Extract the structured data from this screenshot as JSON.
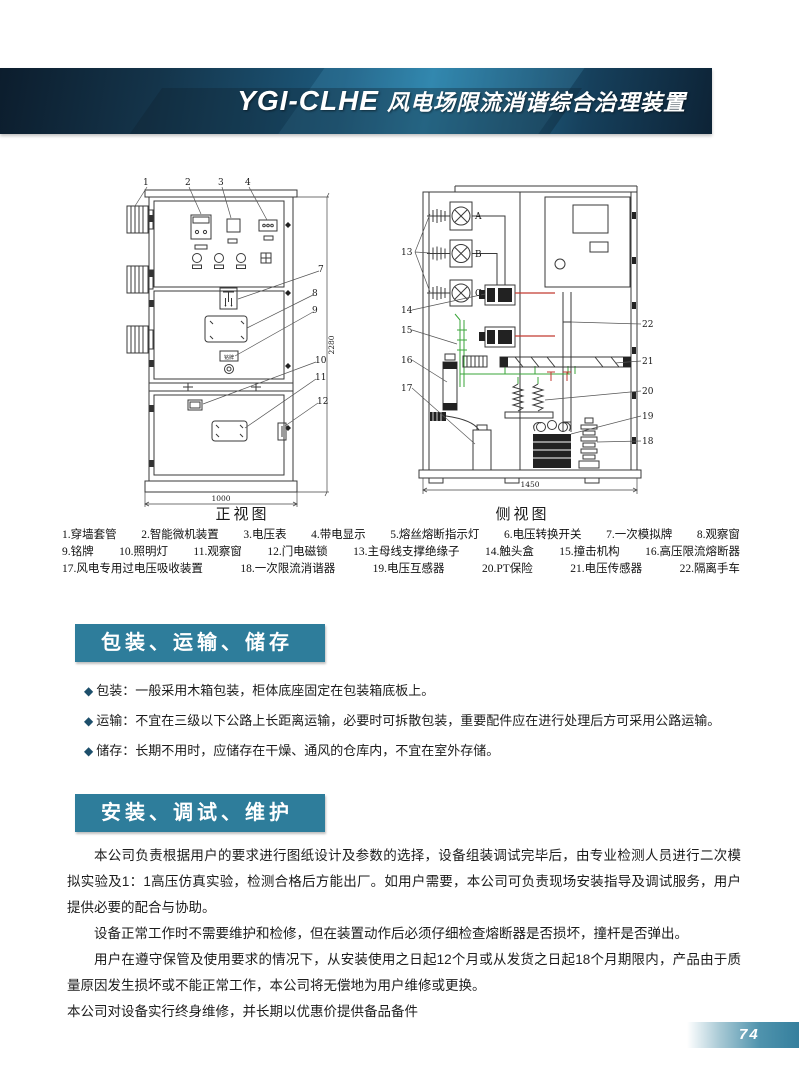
{
  "header": {
    "title_latin": "YGI-CLHE",
    "title_cn": "风电场限流消谐综合治理装置"
  },
  "diagrams": {
    "front": {
      "caption": "正视图",
      "width_dim": "1000",
      "height_dim": "2280",
      "nameplate_text": "铭牌",
      "top_callouts": [
        "1",
        "2",
        "3",
        "4"
      ],
      "right_callouts": [
        "7",
        "8",
        "9",
        "10",
        "11",
        "12"
      ]
    },
    "side": {
      "caption": "侧视图",
      "width_dim": "1450",
      "phases": [
        "A",
        "B",
        "C"
      ],
      "left_callouts": [
        "13",
        "14",
        "15",
        "16",
        "17"
      ],
      "right_callouts": [
        "22",
        "21",
        "20",
        "19",
        "18"
      ]
    }
  },
  "parts_rows": [
    [
      "1.穿墙套管",
      "2.智能微机装置",
      "3.电压表",
      "4.带电显示",
      "5.熔丝熔断指示灯",
      "6.电压转换开关",
      "7.一次模拟牌",
      "8.观察窗"
    ],
    [
      "9.铭牌",
      "10.照明灯",
      "11.观察窗",
      "12.门电磁锁",
      "13.主母线支撑绝缘子",
      "14.触头盒",
      "15.撞击机构",
      "16.高压限流熔断器"
    ],
    [
      "17.风电专用过电压吸收装置",
      "18.一次限流消谐器",
      "19.电压互感器",
      "20.PT保险",
      "21.电压传感器",
      "22.隔离手车"
    ]
  ],
  "sections": {
    "packing": {
      "title": "包装、运输、储存",
      "bullets": [
        {
          "marker": "◆",
          "label": "包装：",
          "text": "一般采用木箱包装，柜体底座固定在包装箱底板上。"
        },
        {
          "marker": "◆",
          "label": "运输：",
          "text": "不宜在三级以下公路上长距离运输，必要时可拆散包装，重要配件应在进行处理后方可采用公路运输。"
        },
        {
          "marker": "◆",
          "label": "储存：",
          "text": "长期不用时，应储存在干燥、通风的仓库内，不宜在室外存储。"
        }
      ]
    },
    "install": {
      "title": "安装、调试、维护",
      "paragraphs": [
        "本公司负责根据用户的要求进行图纸设计及参数的选择，设备组装调试完毕后，由专业检测人员进行二次模拟实验及1：1高压仿真实验，检测合格后方能出厂。如用户需要，本公司可负责现场安装指导及调试服务，用户提供必要的配合与协助。",
        "设备正常工作时不需要维护和检修，但在装置动作后必须仔细检查熔断器是否损坏，撞杆是否弹出。",
        "用户在遵守保管及使用要求的情况下，从安装使用之日起12个月或从发货之日起18个月期限内，产品由于质量原因发生损坏或不能正常工作，本公司将无偿地为用户维修或更换。",
        "本公司对设备实行终身维修，并长期以优惠价提供备品备件"
      ]
    }
  },
  "footer": {
    "page_number": "74"
  }
}
